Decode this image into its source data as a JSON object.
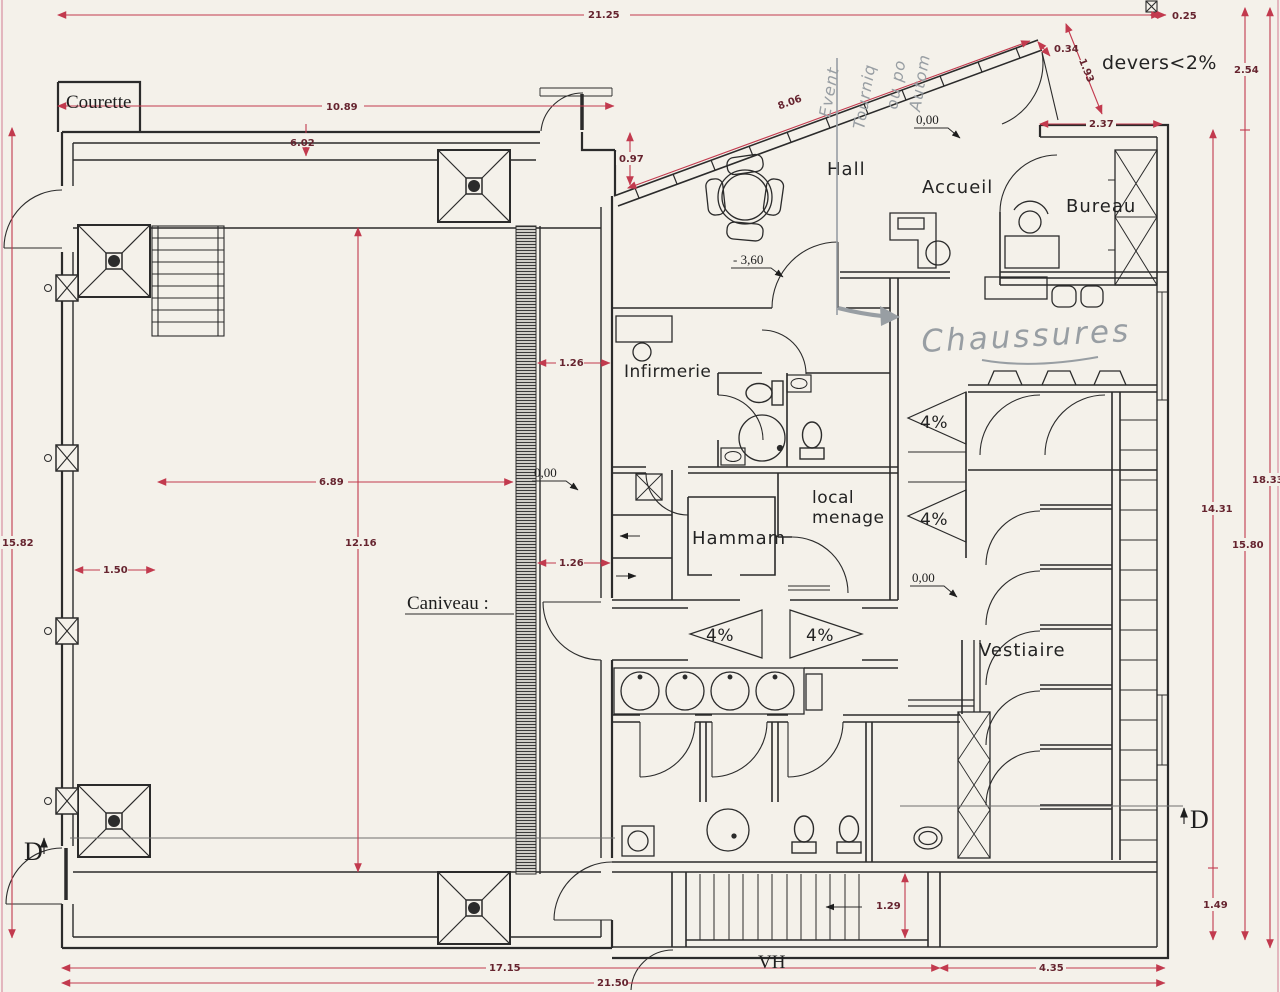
{
  "drawing": {
    "rooms": {
      "courette": "Courette",
      "hall": "Hall",
      "accueil": "Accueil",
      "bureau": "Bureau",
      "infirmerie": "Infirmerie",
      "hammam": "Hammam",
      "vestiaire": "Vestiaire"
    },
    "annotations": {
      "caniveau_label": "Caniveau :",
      "devers_note": "devers<2%",
      "stair_label": "VH",
      "section_marker": "D",
      "ramp_slope": "4%",
      "local_line1": "local",
      "local_line2": "menage"
    },
    "levels": {
      "ground": "0,00",
      "lower": "- 3,60"
    },
    "handwritten": {
      "chaussures": "Chaussures",
      "note_word_1": "Event",
      "note_word_2": "Tourniq",
      "note_word_3": "ou po",
      "note_word_4": "Autom"
    },
    "dimensions": {
      "total_top": "21.25",
      "offset_top_right": "0.25",
      "entry_depth": "2.54",
      "d_0_34": "0.34",
      "d_1_93": "1.93",
      "d_2_37": "2.37",
      "d_10_89": "10.89",
      "d_6_02": "6.02",
      "d_8_06": "8.06",
      "d_0_97": "0.97",
      "d_1_26_upper": "1.26",
      "d_1_26_lower": "1.26",
      "d_6_89": "6.89",
      "d_12_16": "12.16",
      "d_1_50": "1.50",
      "d_15_82": "15.82",
      "d_18_33": "18.33",
      "d_14_31": "14.31",
      "d_15_80": "15.80",
      "d_1_49": "1.49",
      "d_1_29": "1.29",
      "d_17_15": "17.15",
      "d_21_50": "21.50",
      "d_4_35": "4.35"
    }
  },
  "colors": {
    "paper": "#f4f1ea",
    "ink": "#2b2b2b",
    "red": "#c23a4e",
    "dimtext": "#66242f",
    "pencil": "#989ea3"
  }
}
